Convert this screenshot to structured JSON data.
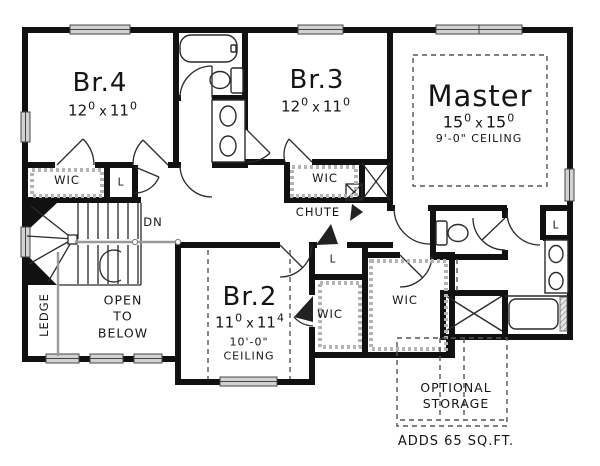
{
  "plan": {
    "rooms": {
      "br4": {
        "name": "Br.4",
        "dim_w": "12",
        "dim_w_sup": "0",
        "dim_sep": "x",
        "dim_h": "11",
        "dim_h_sup": "0"
      },
      "br3": {
        "name": "Br.3",
        "dim_w": "12",
        "dim_w_sup": "0",
        "dim_sep": "x",
        "dim_h": "11",
        "dim_h_sup": "0"
      },
      "master": {
        "name": "Master",
        "dim_w": "15",
        "dim_w_sup": "0",
        "dim_sep": "x",
        "dim_h": "15",
        "dim_h_sup": "0",
        "ceiling": "9'-0\" CEILING"
      },
      "br2": {
        "name": "Br.2",
        "dim_w": "11",
        "dim_w_sup": "0",
        "dim_sep": "x",
        "dim_h": "11",
        "dim_h_sup": "4",
        "ceiling": "10'-0\"\nCEILING"
      }
    },
    "closets": {
      "wic_br4": "WIC",
      "wic_br3": "WIC",
      "wic_br2": "WIC",
      "wic_master": "WIC",
      "linen_upper": "L",
      "linen_hall": "L",
      "linen_master": "L"
    },
    "labels": {
      "down": "DN",
      "chute": "CHUTE",
      "ledge": "LEDGE",
      "open_to_below": "OPEN\nTO\nBELOW",
      "optional_storage": "OPTIONAL\nSTORAGE",
      "optional_storage_note": "ADDS 65 SQ.FT."
    },
    "colors": {
      "wall": "#111111",
      "line": "#2a2a2a",
      "muted": "#9a9a9a",
      "paper": "#ffffff"
    }
  }
}
